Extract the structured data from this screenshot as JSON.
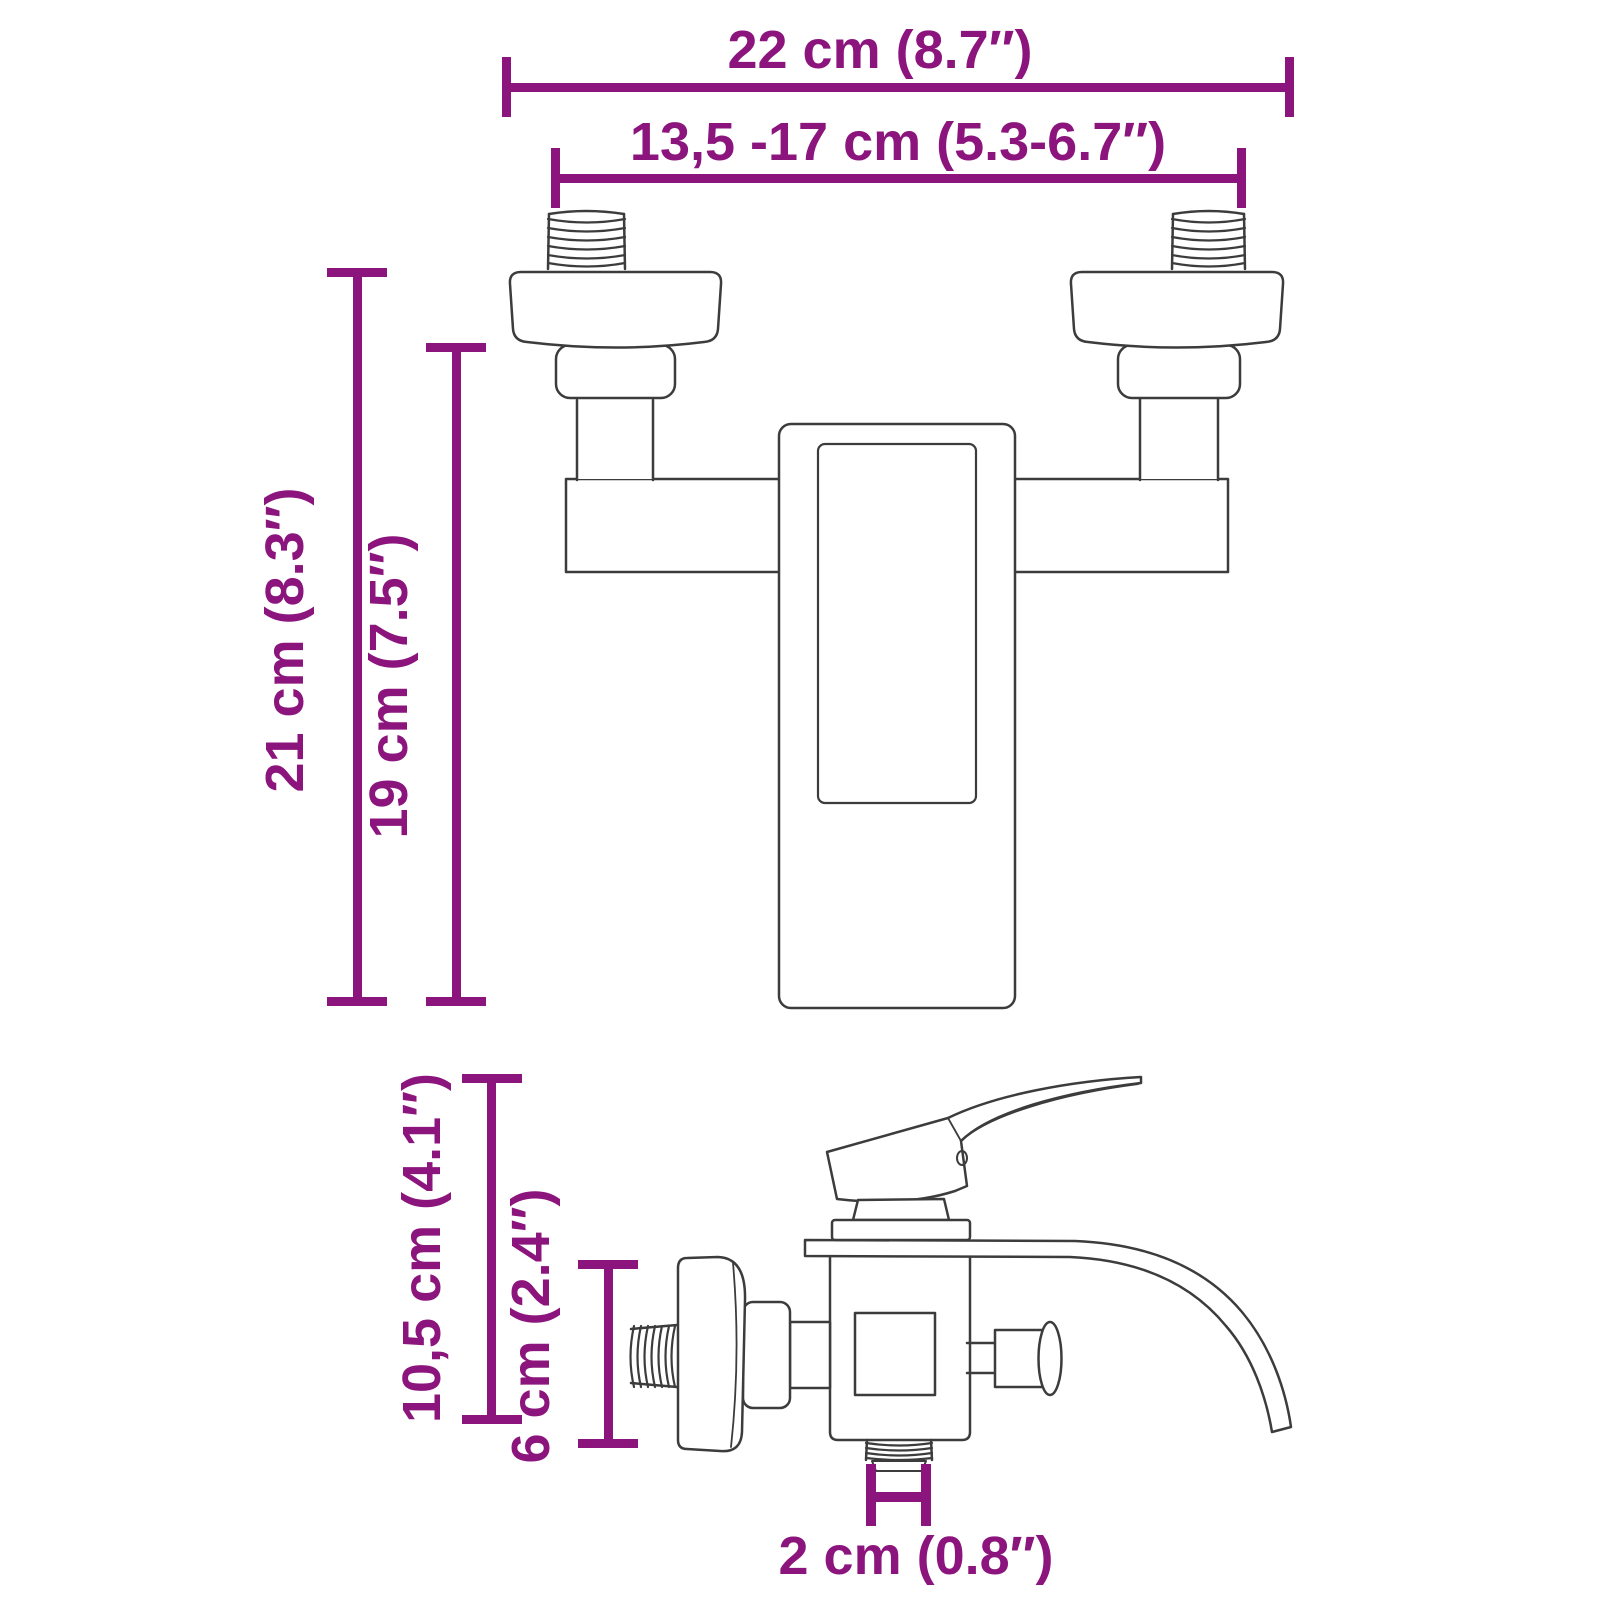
{
  "title": "Bath shower mixer faucet dimension diagram",
  "colors": {
    "dimension": "#8C147D",
    "outline": "#3C3C3C"
  },
  "dims": {
    "overall_width": "22 cm (8.7″)",
    "connection_spacing": "13,5 -17 cm (5.3-6.7″)",
    "overall_height": "21 cm (8.3″)",
    "body_height": "19 cm (7.5″)",
    "side_total_height": "10,5 cm (4.1″)",
    "side_body_height": "6 cm (2.4″)",
    "outlet_width": "2 cm (0.8″)"
  }
}
